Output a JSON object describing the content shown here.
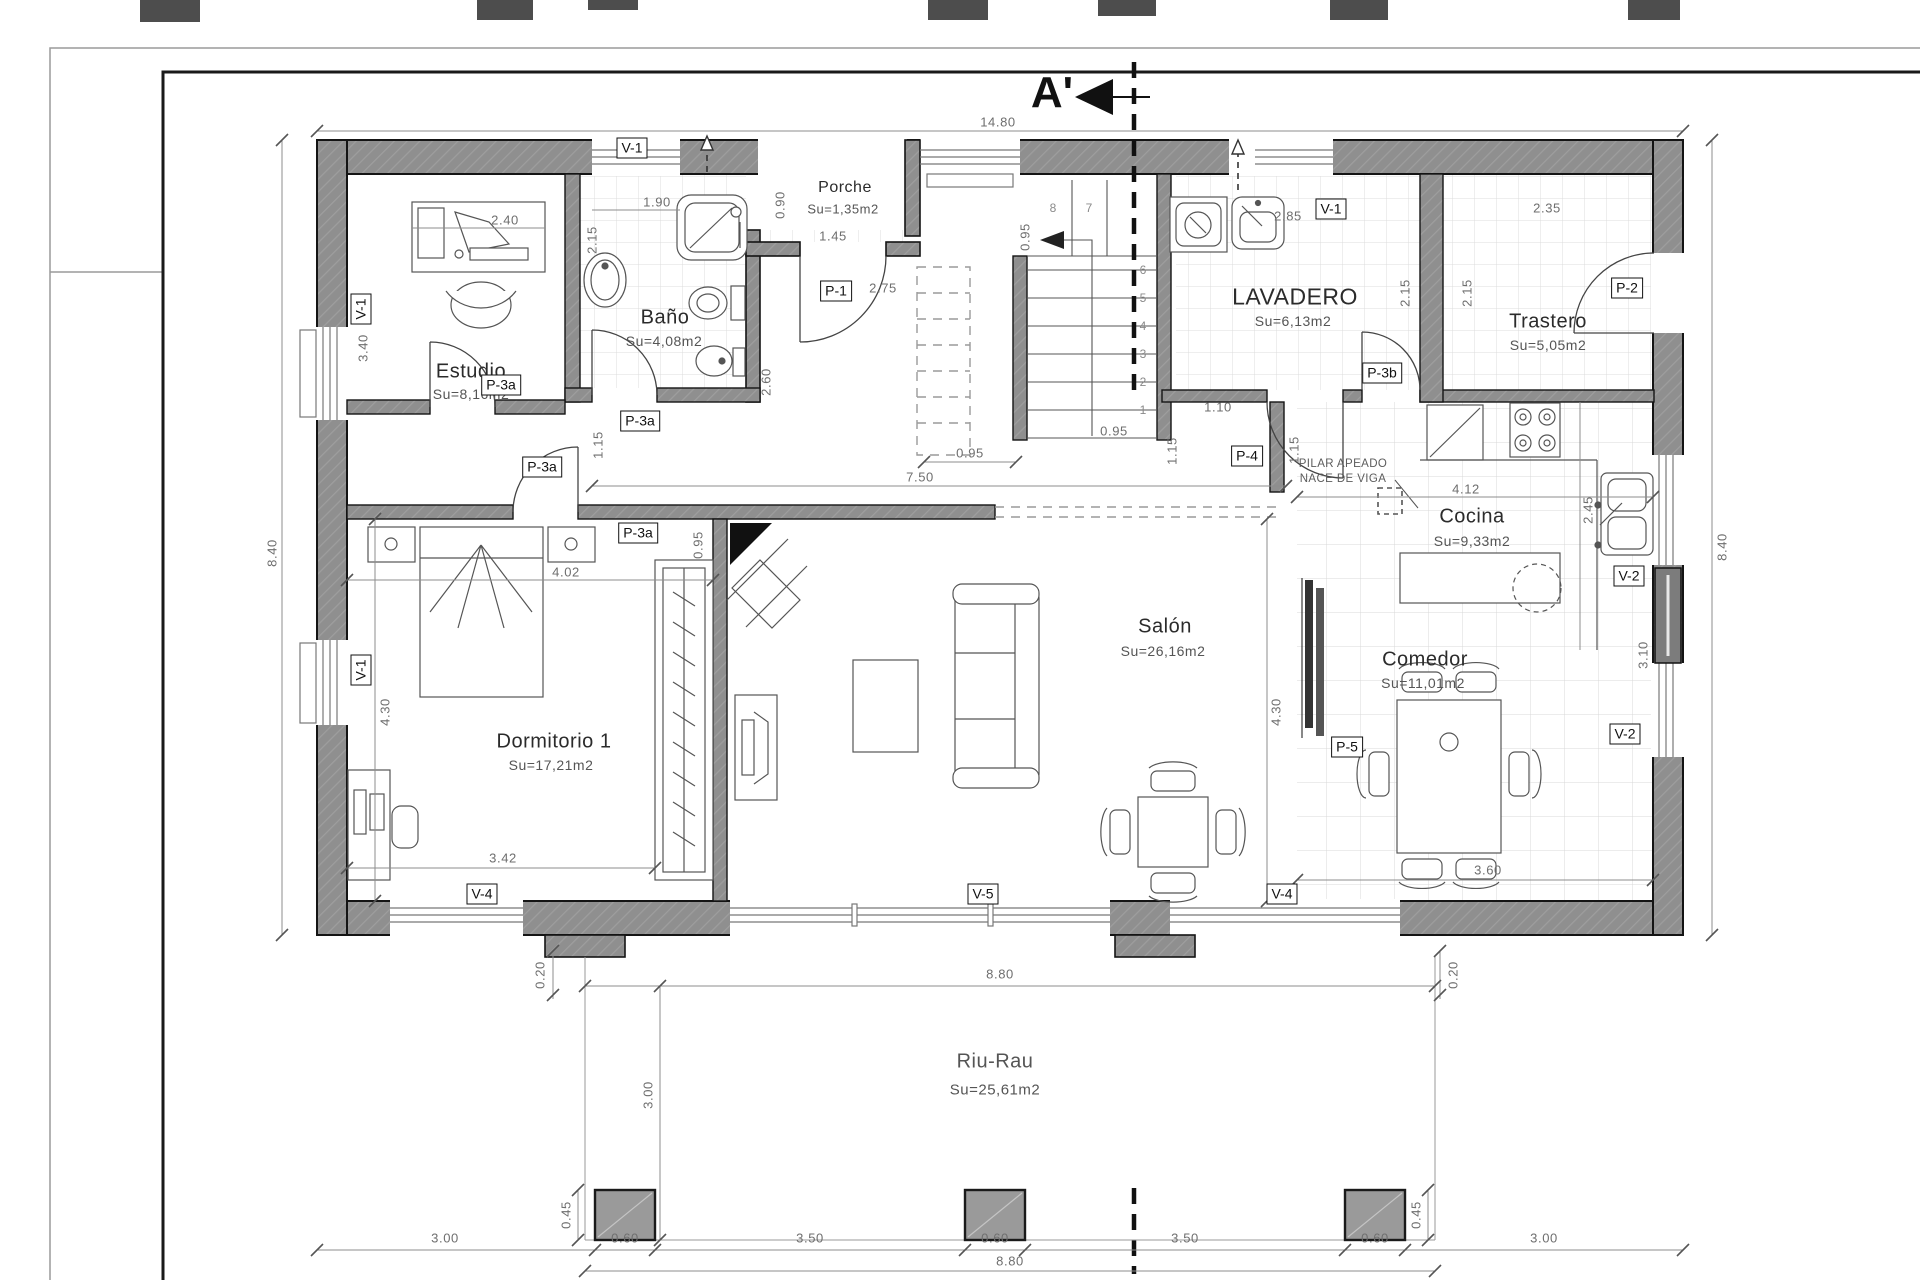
{
  "section": {
    "marker": "A'"
  },
  "rooms": {
    "porche": {
      "name": "Porche",
      "area": "Su=1,35m2"
    },
    "bano": {
      "name": "Baño",
      "area": "Su=4,08m2"
    },
    "estudio": {
      "name": "Estudio",
      "area": "Su=8,16m2"
    },
    "lavadero": {
      "name": "LAVADERO",
      "area": "Su=6,13m2"
    },
    "trastero": {
      "name": "Trastero",
      "area": "Su=5,05m2"
    },
    "cocina": {
      "name": "Cocina",
      "area": "Su=9,33m2"
    },
    "salon": {
      "name": "Salón",
      "area": "Su=26,16m2"
    },
    "comedor": {
      "name": "Comedor",
      "area": "Su=11,01m2"
    },
    "dormitorio1": {
      "name": "Dormitorio 1",
      "area": "Su=17,21m2"
    },
    "riurau": {
      "name": "Riu-Rau",
      "area": "Su=25,61m2"
    }
  },
  "doors": {
    "p1": "P-1",
    "p2": "P-2",
    "p3a": "P-3a",
    "p3b": "P-3b",
    "p4": "P-4",
    "p5": "P-5"
  },
  "windows": {
    "v1": "V-1",
    "v2": "V-2",
    "v4": "V-4",
    "v5": "V-5"
  },
  "annotations": {
    "pilar_line1": "PILAR APEADO",
    "pilar_line2": "NACE DE VIGA"
  },
  "stairs": {
    "steps": [
      "1",
      "2",
      "3",
      "4",
      "5",
      "6",
      "7",
      "8"
    ]
  },
  "dims": {
    "total_width": "14.80",
    "height_left": "8.40",
    "height_right": "8.40",
    "estudio_width": "2.40",
    "estudio_height": "3.40",
    "bano_width": "1.90",
    "bano_height": "2.15",
    "porche_depth": "0.90",
    "porche_width": "1.45",
    "entry_width": "2.75",
    "hall_height": "2.60",
    "hall_seg": "0.95",
    "hall_length": "7.50",
    "stair_width": "0.95",
    "stair_bottom": "0.95",
    "pass_110": "1.10",
    "pass_115a": "1.15",
    "pass_115b": "1.15",
    "hall_door": "1.15",
    "cocina_width": "4.12",
    "cocina_depth": "2.45",
    "lavadero_width": "2.85",
    "trastero_width": "2.35",
    "lavadero_height": "2.15",
    "trastero_height": "2.15",
    "dorm_width": "4.02",
    "wardrobe_width": "0.95",
    "dorm_height": "4.30",
    "salon_height": "4.30",
    "dorm_window": "3.42",
    "comedor_window": "3.60",
    "comedor_height": "3.10",
    "offset_left": "0.20",
    "offset_right": "0.20",
    "riurau_width_top": "8.80",
    "riurau_width_bottom": "8.80",
    "riurau_depth": "3.00",
    "pillar_left": "0.45",
    "pillar_right": "0.45",
    "chain_1": "3.00",
    "chain_2": "0.60",
    "chain_3": "3.50",
    "chain_4": "0.60",
    "chain_5": "3.50",
    "chain_6": "0.60",
    "chain_7": "3.00"
  }
}
